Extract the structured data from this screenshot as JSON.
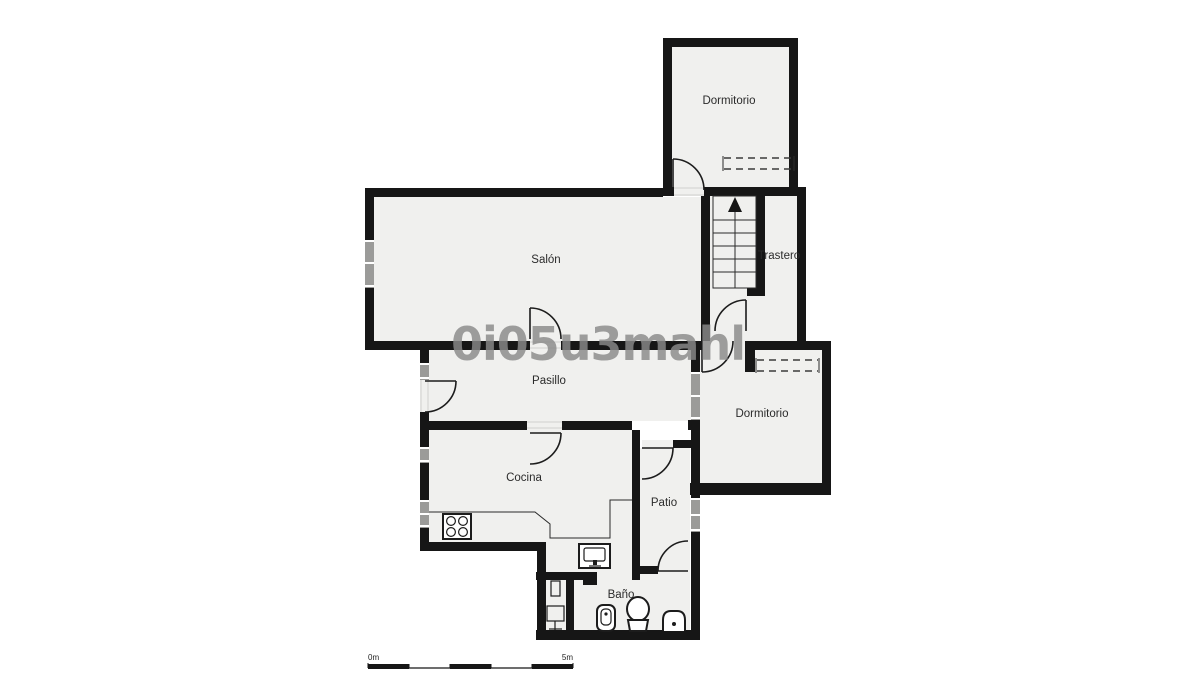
{
  "floorplan": {
    "rooms": {
      "dormitorio_top": {
        "label": "Dormitorio"
      },
      "salon": {
        "label": "Salón"
      },
      "trastero": {
        "label": "Trastero"
      },
      "pasillo": {
        "label": "Pasillo"
      },
      "dormitorio_right": {
        "label": "Dormitorio"
      },
      "cocina": {
        "label": "Cocina"
      },
      "patio": {
        "label": "Patio"
      },
      "bano": {
        "label": "Baño"
      }
    },
    "watermark": {
      "text": "0i05u3mahl"
    },
    "scale_bar": {
      "start_label": "0m",
      "end_label": "5m"
    },
    "colors": {
      "wall": "#161616",
      "floor": "#f0f0ee",
      "window": "#9b9b99",
      "watermark": "#8a8a8a",
      "background": "#ffffff"
    },
    "icons": [
      "stairs-up-arrow-icon",
      "stove-icon",
      "kitchen-sink-icon",
      "toilet-icon",
      "bidet-icon",
      "washbasin-icon",
      "water-heater-icon",
      "shower-stand-icon",
      "closet-dashed-icon"
    ]
  }
}
